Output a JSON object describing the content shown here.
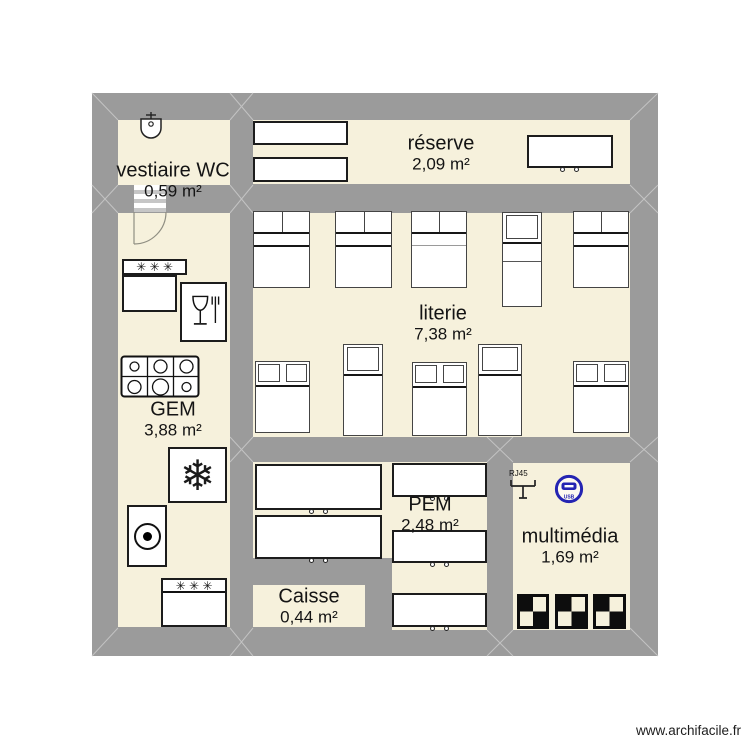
{
  "watermark": "www.archifacile.fr",
  "symbols": {
    "stars": "✳ ✳ ✳",
    "snowflake": "❄",
    "rj45": "RJ45",
    "usb": "USB"
  },
  "colors": {
    "wall": "#9b9b9b",
    "floor": "#f6f1dc",
    "furniture_fill": "#ffffff",
    "outline": "#1c1c1c",
    "usb_blue": "#2424b2",
    "miter_line": "#c3c3c3"
  },
  "plan": {
    "x": 92,
    "y": 93,
    "w": 566,
    "h": 563
  },
  "rooms": [
    {
      "id": "vestiaire-wc",
      "name": "vestiaire WC",
      "area": "0,59 m²",
      "rects": [
        [
          118,
          120,
          112,
          65
        ]
      ],
      "label": [
        173,
        180
      ]
    },
    {
      "id": "reserve",
      "name": "réserve",
      "area": "2,09 m²",
      "rects": [
        [
          253,
          120,
          377,
          64
        ]
      ],
      "label": [
        441,
        153
      ]
    },
    {
      "id": "gem",
      "name": "GEM",
      "area": "3,88 m²",
      "rects": [
        [
          118,
          213,
          112,
          414
        ]
      ],
      "label": [
        173,
        419
      ]
    },
    {
      "id": "literie",
      "name": "literie",
      "area": "7,38 m²",
      "rects": [
        [
          253,
          213,
          377,
          224
        ]
      ],
      "label": [
        443,
        323
      ]
    },
    {
      "id": "pem",
      "name": "PEM",
      "area": "2,48 m²",
      "rects": [
        [
          253,
          462,
          139,
          96
        ],
        [
          392,
          462,
          95,
          168
        ]
      ],
      "label": [
        430,
        514
      ]
    },
    {
      "id": "multimedia",
      "name": "multimédia",
      "area": "1,69 m²",
      "rects": [
        [
          513,
          463,
          117,
          167
        ]
      ],
      "label": [
        570,
        546
      ]
    },
    {
      "id": "caisse",
      "name": "Caisse",
      "area": "0,44 m²",
      "rects": [
        [
          253,
          585,
          112,
          42
        ]
      ],
      "label": [
        309,
        606
      ]
    }
  ],
  "door": {
    "x": 134,
    "y": 185,
    "w": 32,
    "h": 27,
    "r": 32
  },
  "furniture": [
    {
      "type": "sink",
      "x": 137,
      "y": 112,
      "w": 28,
      "h": 33
    },
    {
      "type": "box",
      "x": 253,
      "y": 121,
      "w": 95,
      "h": 24
    },
    {
      "type": "box",
      "x": 253,
      "y": 157,
      "w": 95,
      "h": 25
    },
    {
      "type": "cabinet",
      "x": 527,
      "y": 135,
      "w": 86,
      "h": 33
    },
    {
      "type": "fridge-strip",
      "x": 122,
      "y": 259,
      "w": 65,
      "h": 16
    },
    {
      "type": "box",
      "x": 122,
      "y": 275,
      "w": 55,
      "h": 37
    },
    {
      "type": "dishwasher",
      "x": 180,
      "y": 282,
      "w": 47,
      "h": 60
    },
    {
      "type": "hob",
      "x": 120,
      "y": 355,
      "w": 80,
      "h": 43
    },
    {
      "type": "snowflake",
      "x": 168,
      "y": 447,
      "w": 59,
      "h": 56
    },
    {
      "type": "hotplate",
      "x": 127,
      "y": 505,
      "w": 40,
      "h": 62
    },
    {
      "type": "oven",
      "x": 161,
      "y": 578,
      "w": 66,
      "h": 49
    },
    {
      "type": "bed-double",
      "x": 253,
      "y": 211,
      "w": 57,
      "h": 77
    },
    {
      "type": "bed-double",
      "x": 335,
      "y": 211,
      "w": 57,
      "h": 77
    },
    {
      "type": "bed-double-b",
      "x": 411,
      "y": 211,
      "w": 56,
      "h": 77
    },
    {
      "type": "bed-single-v2",
      "x": 502,
      "y": 212,
      "w": 40,
      "h": 95
    },
    {
      "type": "bed-double",
      "x": 573,
      "y": 211,
      "w": 56,
      "h": 77
    },
    {
      "type": "bed-double-up",
      "x": 255,
      "y": 361,
      "w": 55,
      "h": 72
    },
    {
      "type": "bed-single-v",
      "x": 343,
      "y": 344,
      "w": 40,
      "h": 92
    },
    {
      "type": "bed-double-up",
      "x": 412,
      "y": 362,
      "w": 55,
      "h": 74
    },
    {
      "type": "bed-single-v",
      "x": 478,
      "y": 344,
      "w": 44,
      "h": 92
    },
    {
      "type": "bed-double-up",
      "x": 573,
      "y": 361,
      "w": 56,
      "h": 72
    },
    {
      "type": "cabinet",
      "x": 255,
      "y": 464,
      "w": 127,
      "h": 46
    },
    {
      "type": "cabinet",
      "x": 255,
      "y": 515,
      "w": 127,
      "h": 44
    },
    {
      "type": "cabinet",
      "x": 392,
      "y": 463,
      "w": 95,
      "h": 34
    },
    {
      "type": "cabinet",
      "x": 392,
      "y": 530,
      "w": 95,
      "h": 33
    },
    {
      "type": "cabinet",
      "x": 392,
      "y": 593,
      "w": 95,
      "h": 34
    },
    {
      "type": "rj45",
      "x": 509,
      "y": 469,
      "w": 30,
      "h": 38
    },
    {
      "type": "usb",
      "x": 554,
      "y": 474,
      "w": 30,
      "h": 30
    },
    {
      "type": "checker",
      "x": 517,
      "y": 594,
      "w": 32,
      "h": 35
    },
    {
      "type": "checker",
      "x": 555,
      "y": 594,
      "w": 33,
      "h": 35
    },
    {
      "type": "checker",
      "x": 593,
      "y": 594,
      "w": 33,
      "h": 35
    }
  ]
}
